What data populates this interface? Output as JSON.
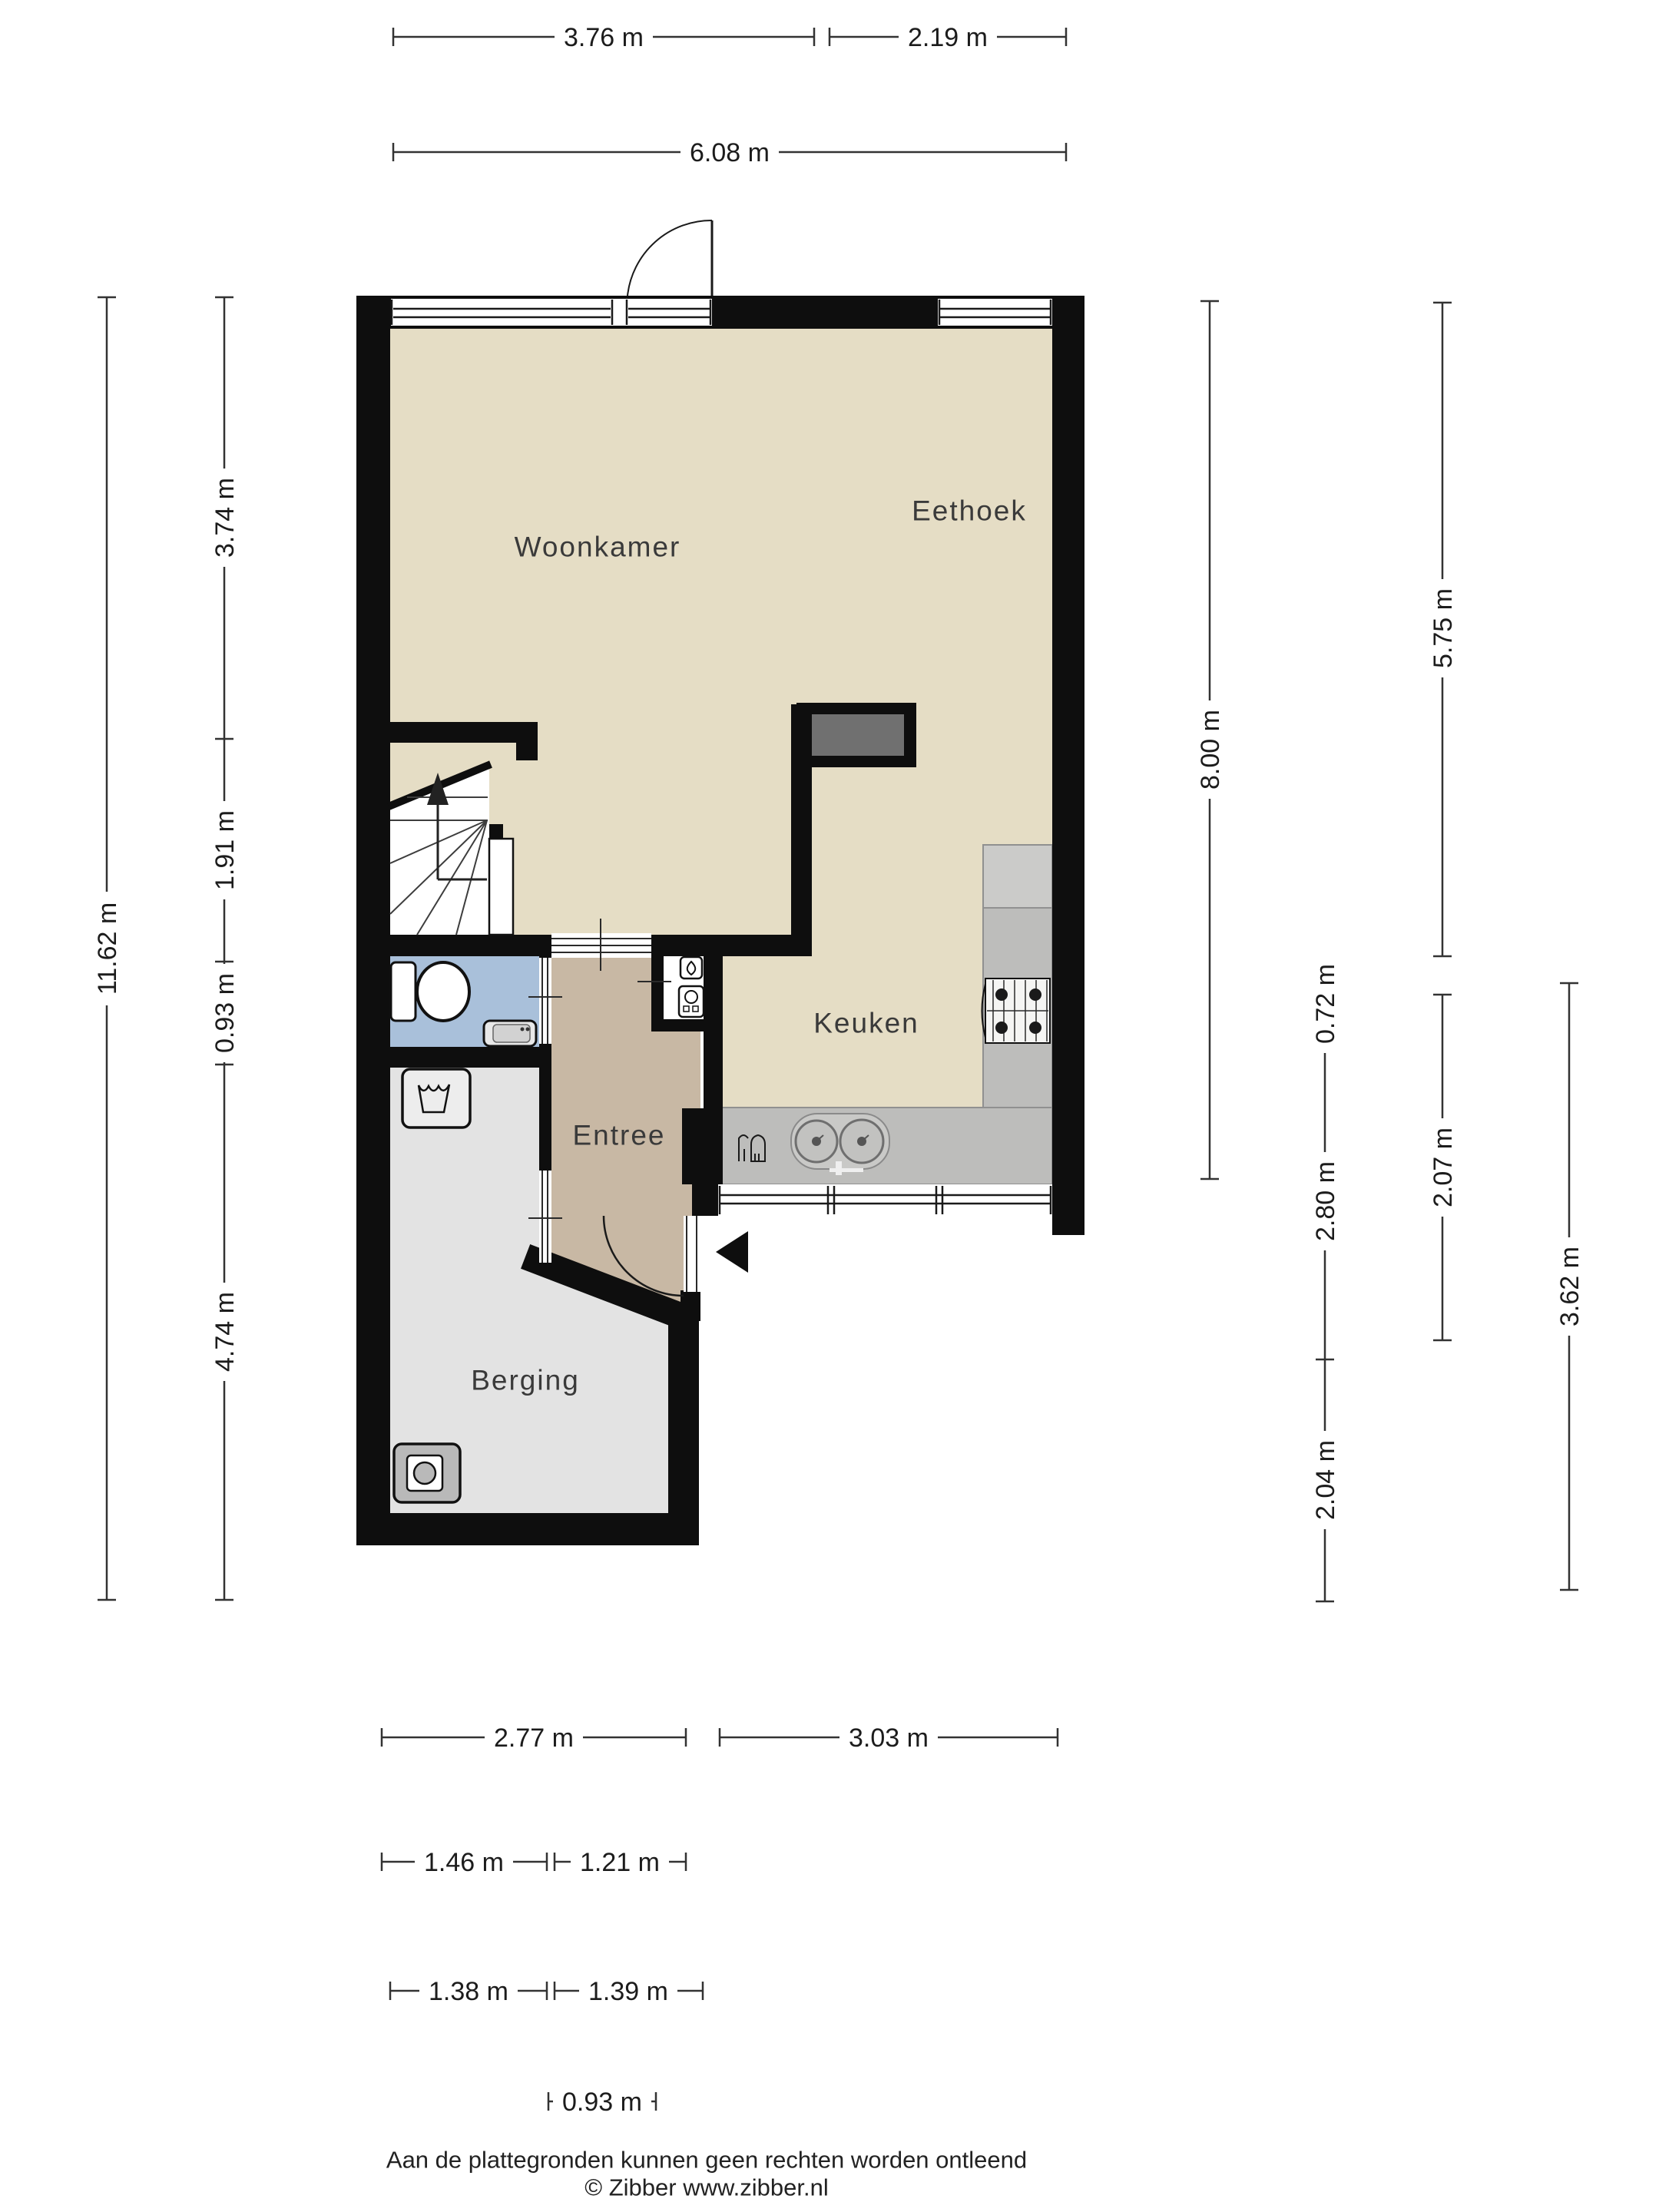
{
  "rooms": [
    {
      "id": "woonkamer",
      "label": "Woonkamer"
    },
    {
      "id": "eethoek",
      "label": "Eethoek"
    },
    {
      "id": "keuken",
      "label": "Keuken"
    },
    {
      "id": "entree",
      "label": "Entree"
    },
    {
      "id": "berging",
      "label": "Berging"
    }
  ],
  "dimensions": {
    "top": [
      "3.76 m",
      "2.19 m",
      "6.08 m"
    ],
    "left": [
      "11.62 m",
      "3.74 m",
      "1.91 m",
      "0.93 m",
      "4.74 m"
    ],
    "right": [
      "8.00 m",
      "0.72 m",
      "2.80 m",
      "2.04 m",
      "5.75 m",
      "2.07 m",
      "3.62 m"
    ],
    "bottom": [
      "2.77 m",
      "3.03 m",
      "1.46 m",
      "1.21 m",
      "1.38 m",
      "1.39 m",
      "0.93 m"
    ]
  },
  "footer": {
    "disclaimer": "Aan de plattegronden kunnen geen rechten worden ontleend",
    "credit": "© Zibber www.zibber.nl"
  },
  "icons": [
    "stairs-up-arrow-icon",
    "toilet-icon",
    "hand-basin-icon",
    "washing-machine-icon",
    "dryer-icon",
    "boiler-icon",
    "water-heater-icon",
    "gas-hob-icon",
    "double-sink-icon",
    "dishwasher-icon",
    "entrance-arrow-icon",
    "door-swing-arc",
    "window-glazing"
  ],
  "colors": {
    "wall": "#0e0e0e",
    "floor_living": "#e5ddc5",
    "floor_entree": "#c8b8a4",
    "floor_toilet": "#a9c0da",
    "floor_berging": "#e3e3e3",
    "counter": "#bdbdbb",
    "counter_light": "#cbcbc9",
    "chimney": "#707070"
  }
}
